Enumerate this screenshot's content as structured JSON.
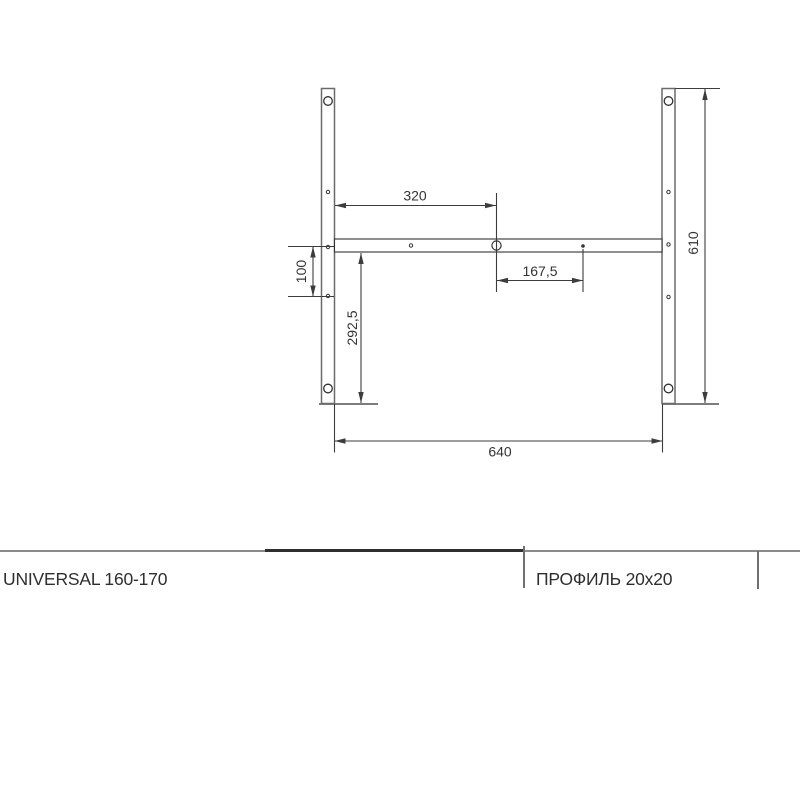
{
  "drawing": {
    "type": "technical-dimension-drawing",
    "dimensions": {
      "top_width": "320",
      "right_hole_offset": "167,5",
      "left_hole_spacing": "100",
      "lower_height": "292,5",
      "bar_height": "610",
      "overall_width": "640"
    },
    "colors": {
      "dimension_line": "#3c3c3c",
      "bar_outline": "#6a6a6a",
      "rule_dark": "#2f2f2f",
      "rule_gray": "#8a8a8a"
    }
  },
  "title_block": {
    "model": "UNIVERSAL 160-170",
    "profile": "ПРОФИЛЬ 20x20"
  }
}
